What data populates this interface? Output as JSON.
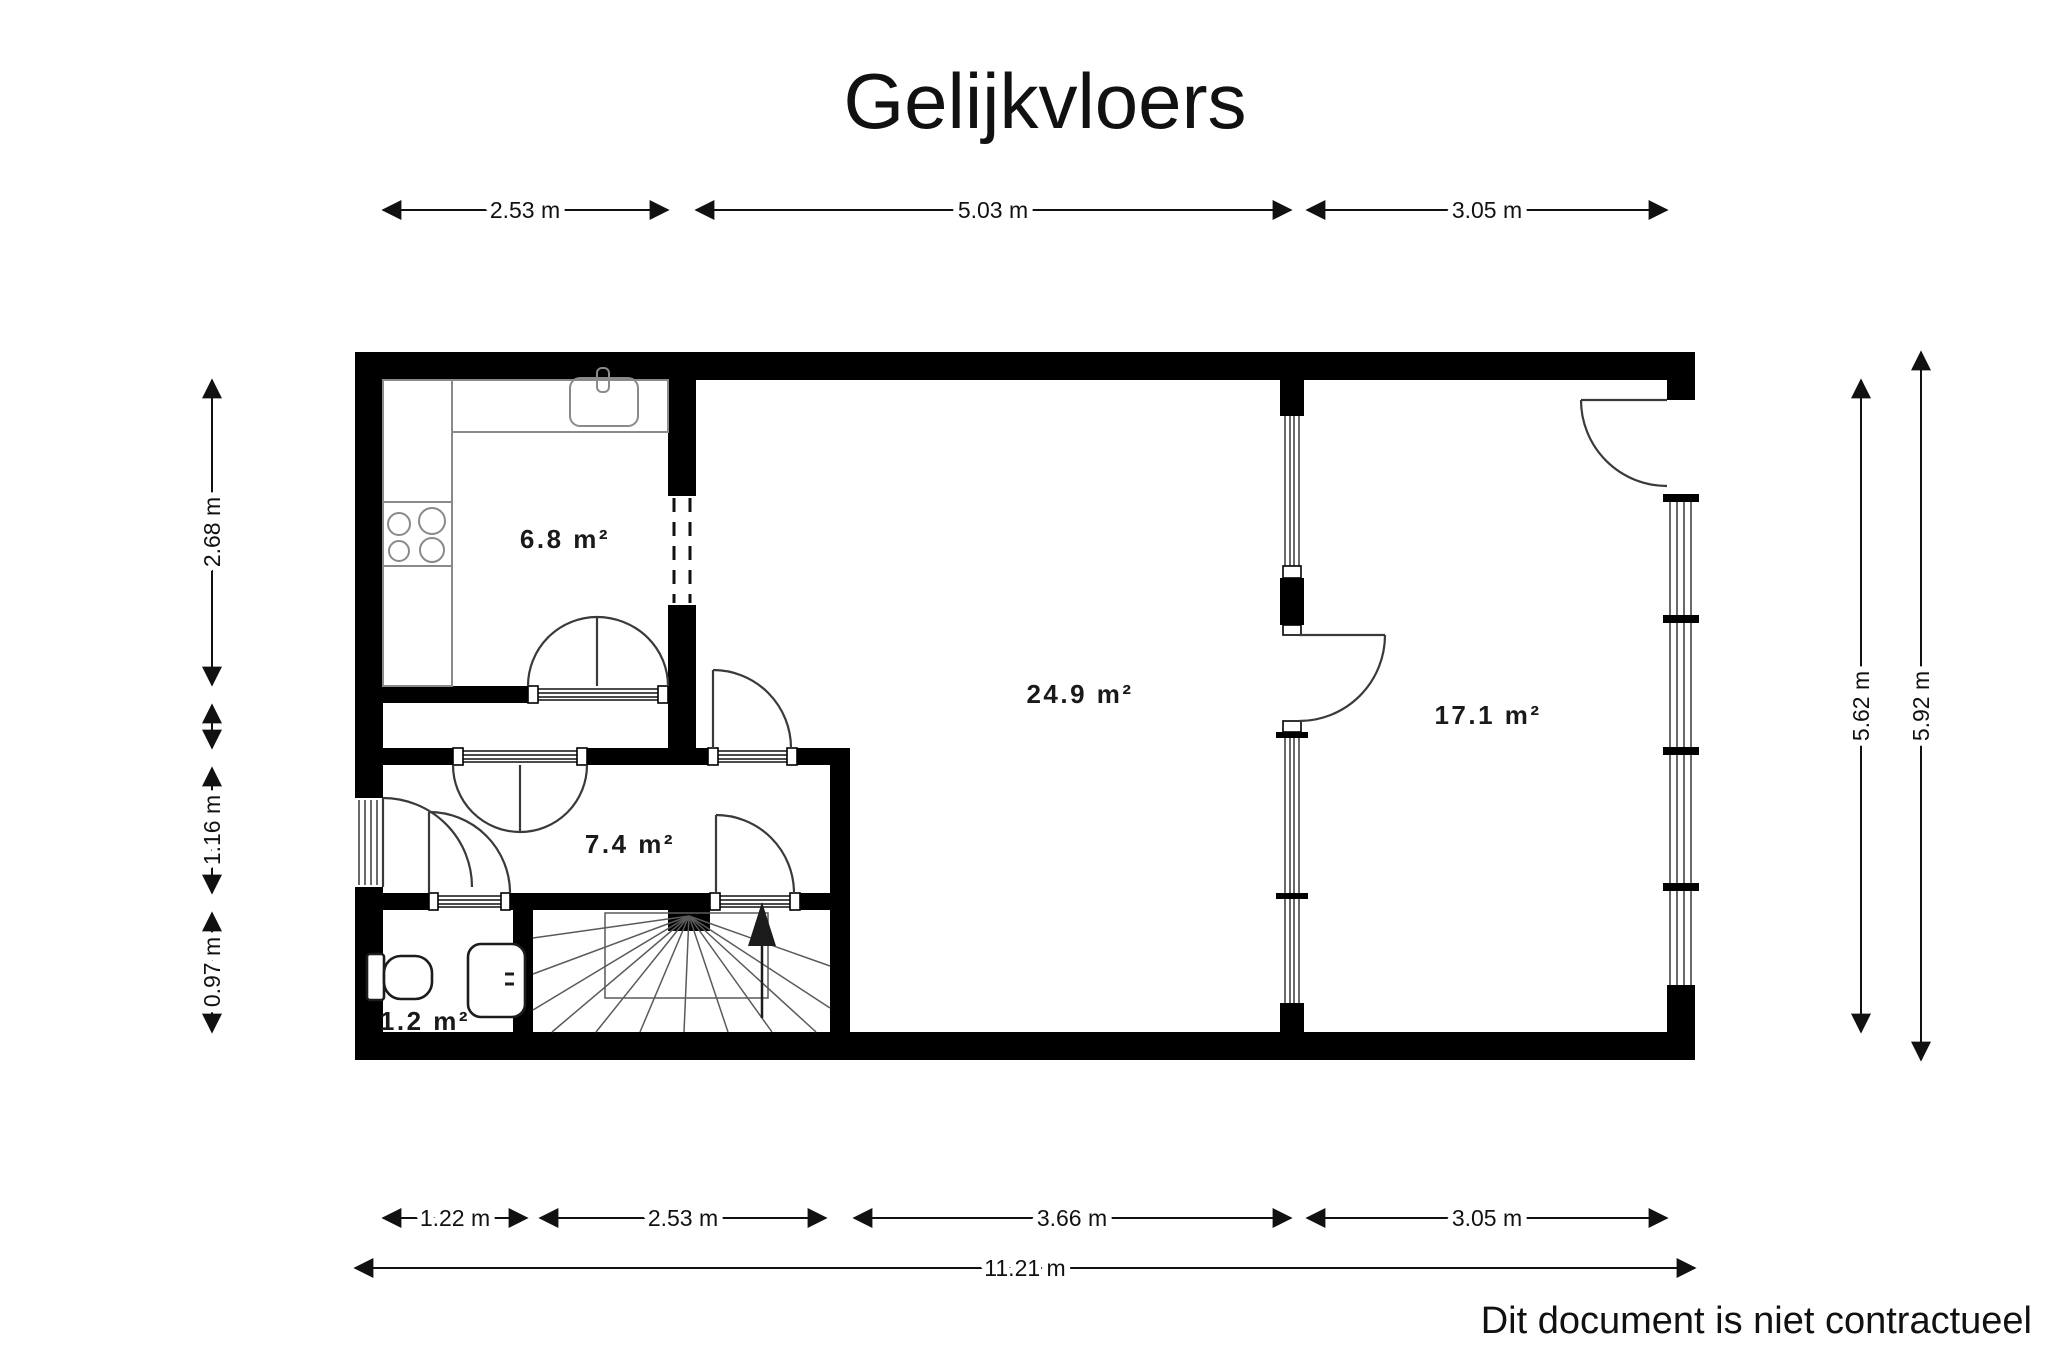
{
  "title": "Gelijkvloers",
  "footer": "Dit document is niet contractueel",
  "rooms": {
    "kitchen": "6.8 m²",
    "living": "24.9 m²",
    "garage": "17.1 m²",
    "hall": "7.4 m²",
    "wc": "1.2 m²"
  },
  "dims": {
    "top": [
      "2.53 m",
      "5.03 m",
      "3.05 m"
    ],
    "left": [
      "2.68 m",
      "1.16 m",
      "0.97 m"
    ],
    "right": [
      "5.62 m",
      "5.92 m"
    ],
    "bottom": [
      "1.22 m",
      "2.53 m",
      "3.66 m",
      "3.05 m"
    ],
    "total": "11.21 m"
  }
}
